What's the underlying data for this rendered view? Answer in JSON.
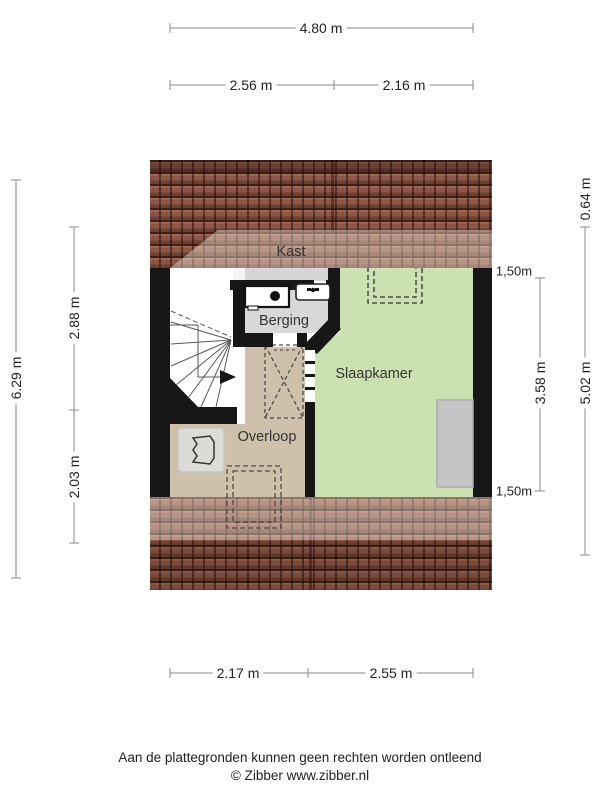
{
  "colors": {
    "roof-base": "#8a5747",
    "wall": "#161616",
    "bedroom-green": "#cbe1b2",
    "landing-tan": "#cfc0ac",
    "storage-gray": "#d8d8d8",
    "closet-strip": "#d5d5d5",
    "furniture-gray": "#c4c4c4",
    "dim-line": "#8a8a8a"
  },
  "rooms": {
    "closet": "Kast",
    "storage": "Berging",
    "bedroom": "Slaapkamer",
    "landing": "Overloop"
  },
  "dimensions": {
    "top": {
      "total": "4.80 m",
      "left": "2.56 m",
      "right": "2.16 m"
    },
    "bottom": {
      "left": "2.17 m",
      "right": "2.55 m"
    },
    "left": {
      "total": "6.29 m",
      "upper": "2.88 m",
      "lower": "2.03 m"
    },
    "right": {
      "roof_top": "0.64 m",
      "outer_total": "5.02 m",
      "inner": "3.58 m",
      "height_line_top": "1,50m",
      "height_line_bottom": "1,50m"
    }
  },
  "icons": {
    "washing_machine": "washing-machine-icon",
    "sink": "sink-tap-icon",
    "boiler": "boiler-unit-icon",
    "stair_arrow": "stair-direction-arrow-icon"
  },
  "footer": {
    "disclaimer": "Aan de plattegronden kunnen geen rechten worden ontleend",
    "copyright": "© Zibber www.zibber.nl"
  }
}
